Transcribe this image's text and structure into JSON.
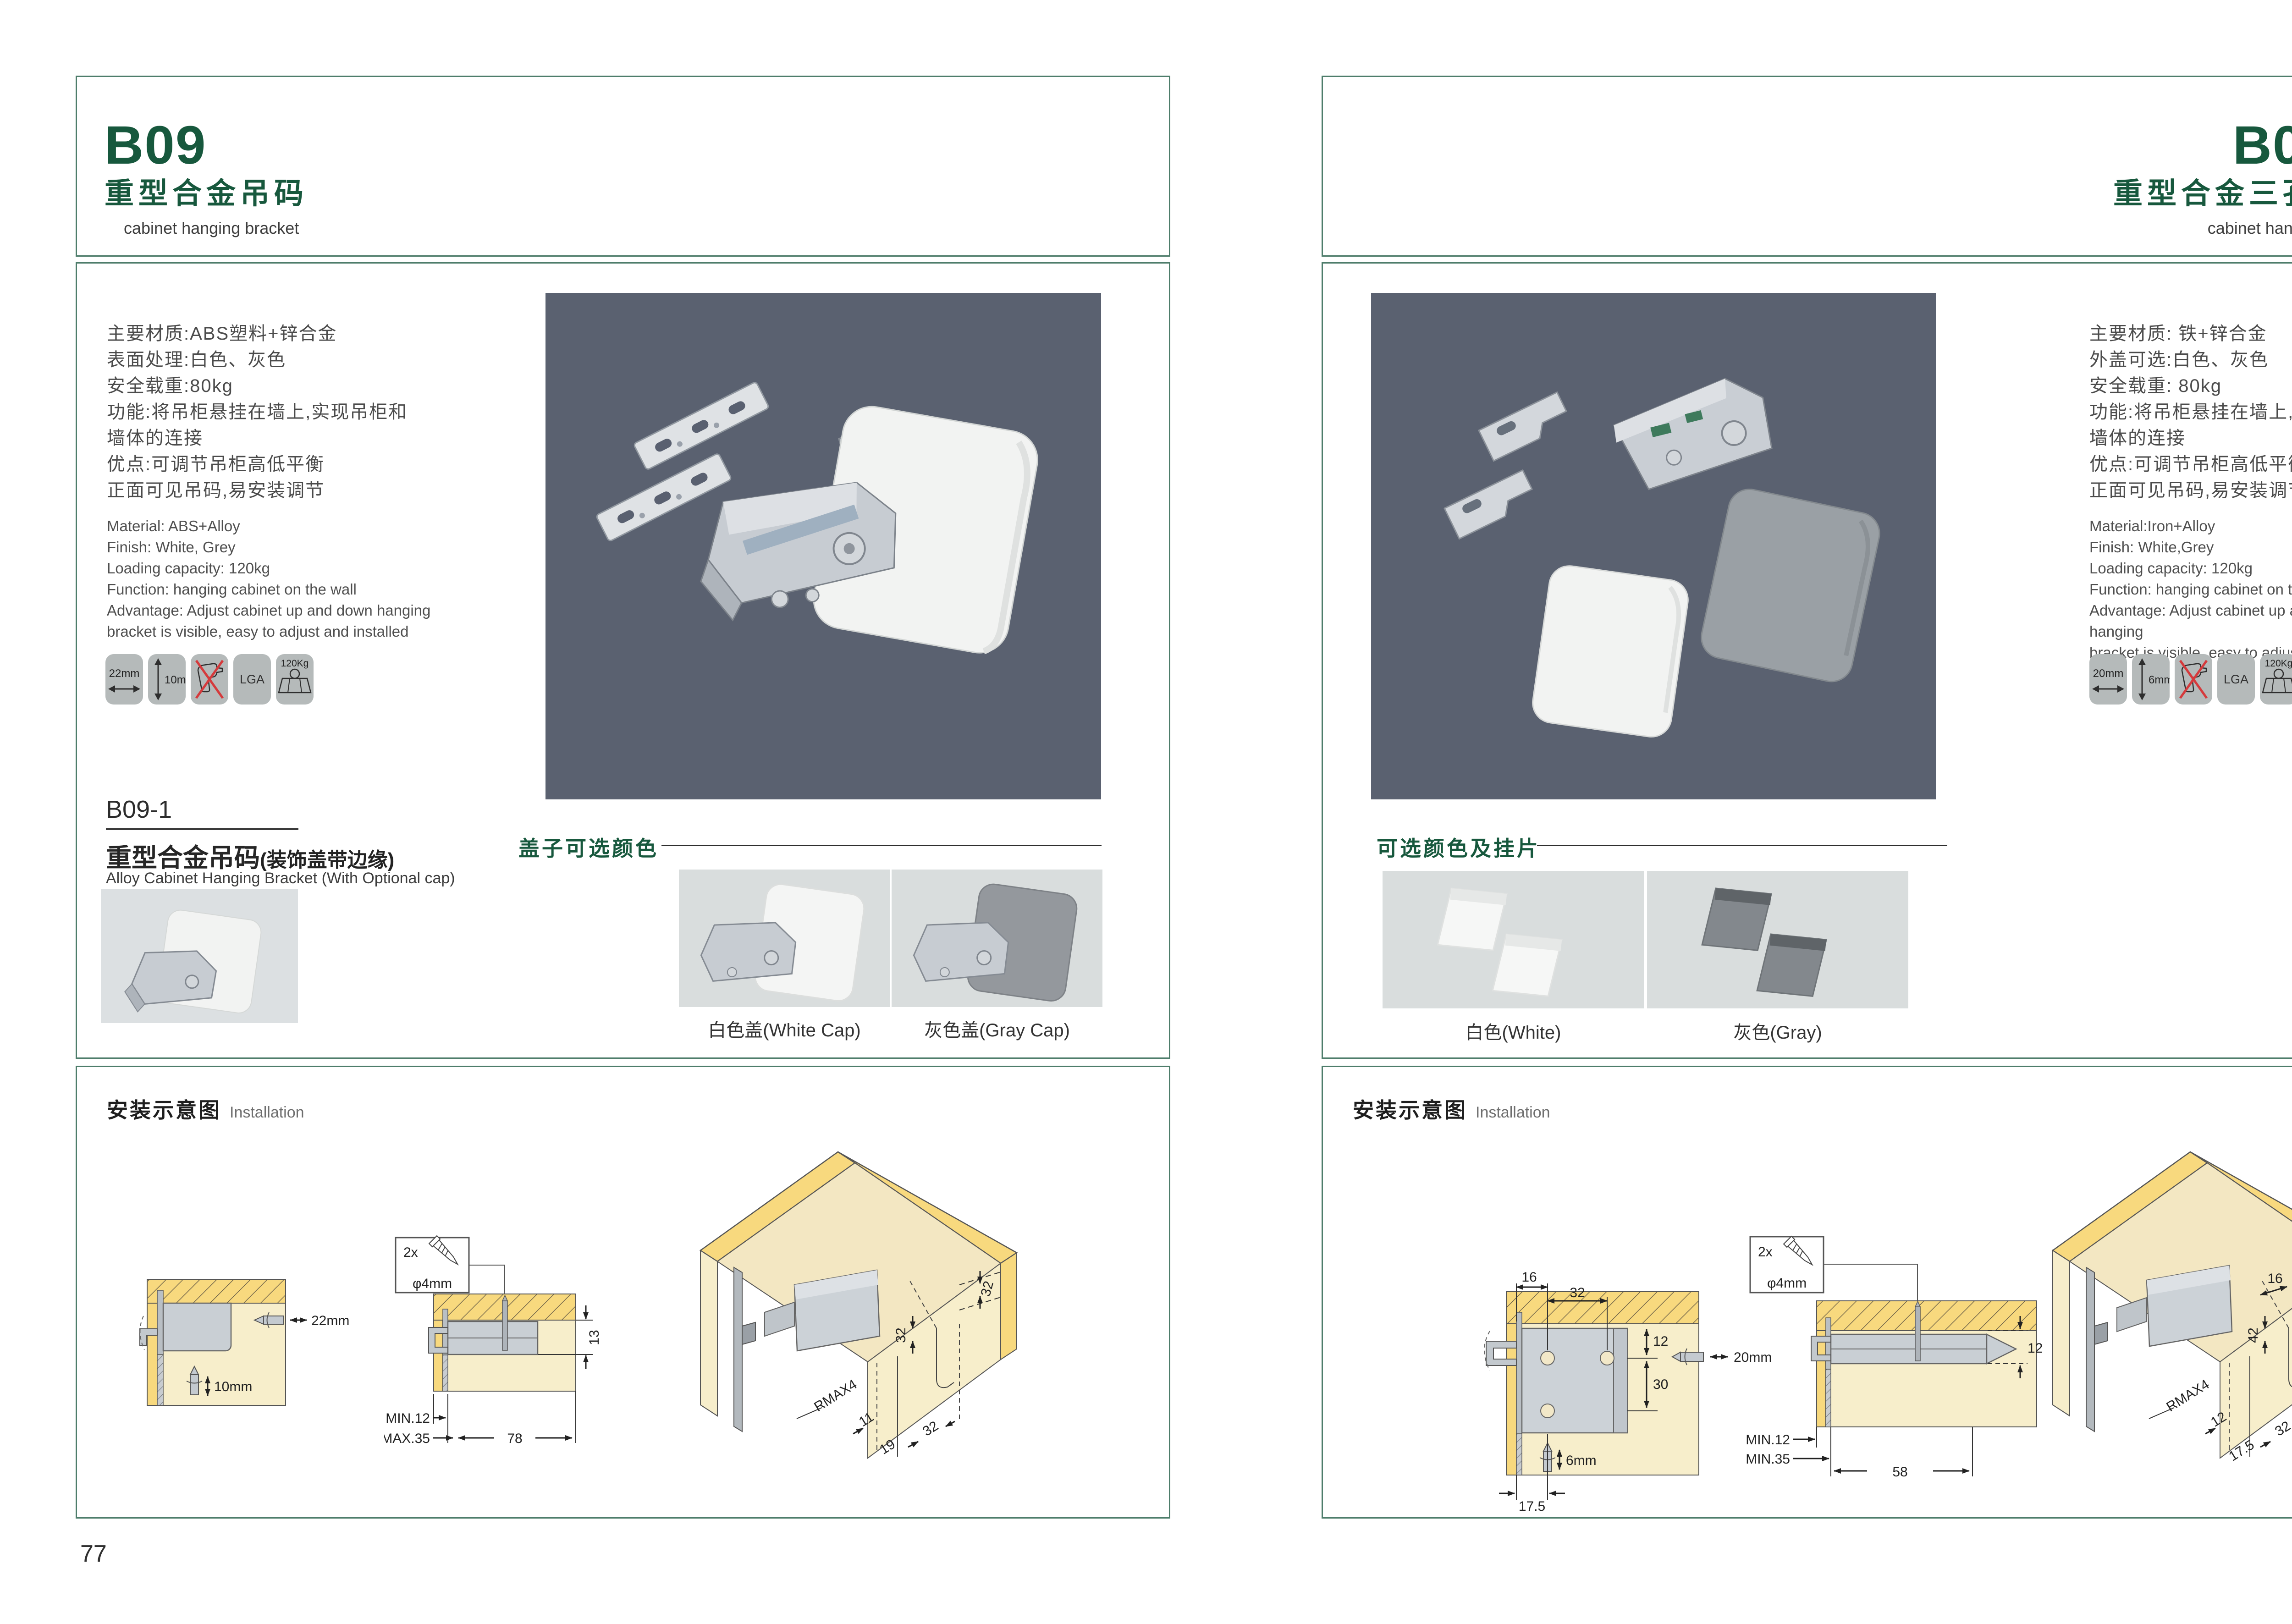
{
  "colors": {
    "accent_green": "#17583d",
    "border_green": "#4e7d6b",
    "photo_bg": "#5a6170",
    "wood_yellow": "#f8d97e"
  },
  "left": {
    "page_number": "77",
    "header": {
      "code": "B09",
      "title_cn": "重型合金吊码",
      "title_en": "cabinet hanging bracket"
    },
    "specs_cn": [
      "主要材质:ABS塑料+锌合金",
      "表面处理:白色、灰色",
      "安全载重:80kg",
      "功能:将吊柜悬挂在墙上,实现吊柜和",
      "墙体的连接",
      "优点:可调节吊柜高低平衡",
      "正面可见吊码,易安装调节"
    ],
    "specs_en": [
      "Material: ABS+Alloy",
      "Finish: White, Grey",
      "Loading capacity: 120kg",
      "Function: hanging cabinet on the wall",
      "Advantage: Adjust cabinet up and down hanging",
      "bracket is visible, easy to adjust and installed"
    ],
    "badges": {
      "width": "22mm",
      "height": "10mm",
      "lga": "LGA",
      "load": "120Kg"
    },
    "sub": {
      "code": "B09-1",
      "cn": "重型合金吊码",
      "cn_paren": "(装饰盖带边缘)",
      "en": "Alloy Cabinet Hanging Bracket (With Optional cap)"
    },
    "caps": {
      "label": "盖子可选颜色",
      "white": "白色盖(White Cap)",
      "gray": "灰色盖(Gray Cap)"
    },
    "install": {
      "cn": "安装示意图",
      "en": "Installation",
      "screw_count": "2x",
      "screw_dia": "φ4mm",
      "d1": {
        "w": "22mm",
        "h": "10mm"
      },
      "d2": {
        "side": "13",
        "min": "MIN.12",
        "max": "MAX.35",
        "span": "78"
      },
      "d3": {
        "t": "32",
        "m": "32",
        "r": "RMAX4",
        "a": "11",
        "b": "19",
        "c": "32"
      }
    }
  },
  "right": {
    "page_number": "78",
    "header": {
      "code": "B09-3",
      "title_cn": "重型合金三孔吊码",
      "title_en": "cabinet hanging bracket"
    },
    "specs_cn": [
      "主要材质: 铁+锌合金",
      "外盖可选:白色、灰色",
      "安全载重: 80kg",
      "功能:将吊柜悬挂在墙上,实现吊柜和",
      "墙体的连接",
      "优点:可调节吊柜高低平衡",
      "正面可见吊码,易安装调节"
    ],
    "specs_en": [
      "Material:Iron+Alloy",
      "Finish: White,Grey",
      "Loading capacity: 120kg",
      "Function: hanging cabinet on the wall",
      "Advantage: Adjust cabinet up and down hanging",
      "bracket is visible, easy to adjust and installed"
    ],
    "badges": {
      "width": "20mm",
      "height": "6mm",
      "lga": "LGA",
      "load": "120Kg"
    },
    "caps": {
      "label": "可选颜色及挂片",
      "white": "白色(White)",
      "gray": "灰色(Gray)"
    },
    "install": {
      "cn": "安装示意图",
      "en": "Installation",
      "screw_count": "2x",
      "screw_dia": "φ4mm",
      "d1": {
        "t1": "16",
        "t2": "32",
        "r1": "12",
        "r2": "30",
        "bh": "20mm",
        "bv": "6mm",
        "b": "17.5"
      },
      "d2": {
        "side": "12",
        "min1": "MIN.12",
        "min2": "MIN.35",
        "span": "58"
      },
      "d3": {
        "t": "12",
        "t2": "16",
        "m": "42",
        "r": "RMAX4",
        "a": "12",
        "b": "17.5",
        "c": "32"
      }
    }
  }
}
